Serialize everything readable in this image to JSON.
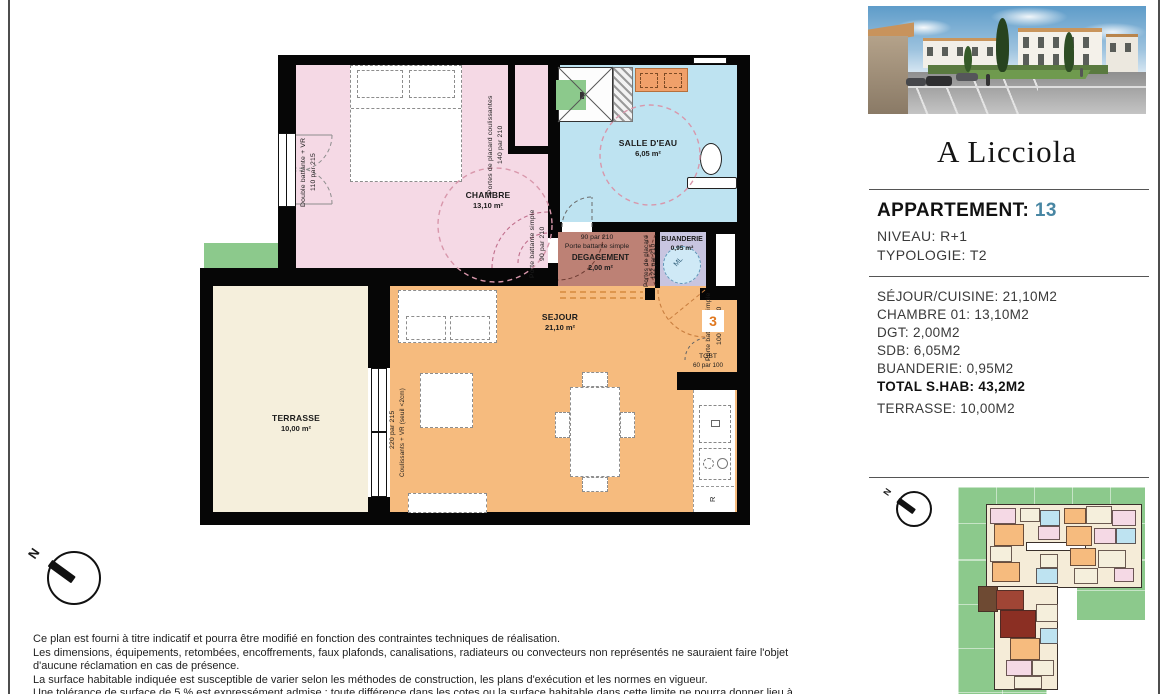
{
  "panel": {
    "logo": "A Licciola",
    "apartment_label": "APPARTEMENT:",
    "apartment_number": "13",
    "niveau": "NIVEAU: R+1",
    "typologie": "TYPOLOGIE: T2",
    "areas": [
      "SÉJOUR/CUISINE: 21,10M2",
      "CHAMBRE 01: 13,10M2",
      "DGT: 2,00M2",
      "SDB: 6,05M2",
      "BUANDERIE: 0,95M2"
    ],
    "total": "TOTAL S.HAB: 43,2M2",
    "terrasse": "TERRASSE: 10,00M2"
  },
  "plan": {
    "rooms": {
      "chambre": {
        "name": "CHAMBRE",
        "area": "13,10 m²"
      },
      "salle_deau": {
        "name": "SALLE D'EAU",
        "area": "6,05 m²"
      },
      "degagement": {
        "name": "DEGAGEMENT",
        "area": "2,00 m²"
      },
      "buanderie": {
        "name": "BUANDERIE",
        "area": "0,95 m²"
      },
      "sejour": {
        "name": "SEJOUR",
        "area": "21,10 m²"
      },
      "terrasse": {
        "name": "TERRASSE",
        "area": "10,00 m²"
      }
    },
    "labels": {
      "placard_chambre": "Portes de placard coulissantes",
      "placard_chambre_dim": "140 par 210",
      "fenetre_chambre": "Double battante + VR",
      "fenetre_chambre_dim": "110 par 215",
      "porte_chambre": "Porte battante simple",
      "porte_chambre_dim": "90 par 210",
      "porte_sde_dim": "90 par 210",
      "porte_sde": "Porte battante simple",
      "placard_dgt": "Portes de placard",
      "placard_dgt_dim": "122 par 210",
      "baie_vitree": "Coulissants + VR (seuil <2cm)",
      "baie_vitree_dim": "220 par 215",
      "porte_entree": "Porte battante simple",
      "porte_entree_dim": "100 par 210",
      "entrance_number": "3",
      "tgbt": "TGBT",
      "tgbt_dim": "60 par 100",
      "fridge": "R",
      "lave_linge": "ML",
      "north": "N"
    }
  },
  "colors": {
    "chambre": "#f5d9e5",
    "salle_deau": "#bee3f1",
    "degagement": "#bd8175",
    "buanderie": "#c8c5e0",
    "sejour": "#f6bb7e",
    "terrasse": "#f5efdc",
    "vegetation": "#8cc98c",
    "accent_teal": "#4886a3",
    "entrance_orange": "#e07820"
  },
  "disclaimer": "Ce plan est fourni à titre indicatif et pourra être modifié en fonction des contraintes techniques de réalisation.\nLes dimensions, équipements, retombées, encoffrements, faux plafonds, canalisations, radiateurs ou convecteurs non représentés ne sauraient faire l'objet\nd'aucune réclamation en cas de présence.\nLa surface habitable indiquée est susceptible de varier selon les méthodes de construction, les plans d'exécution et les normes en vigueur.\nUne tolérance de surface de 5 % est expressément admise : toute différence dans les cotes ou la surface habitable dans cette limite ne pourra donner lieu à"
}
